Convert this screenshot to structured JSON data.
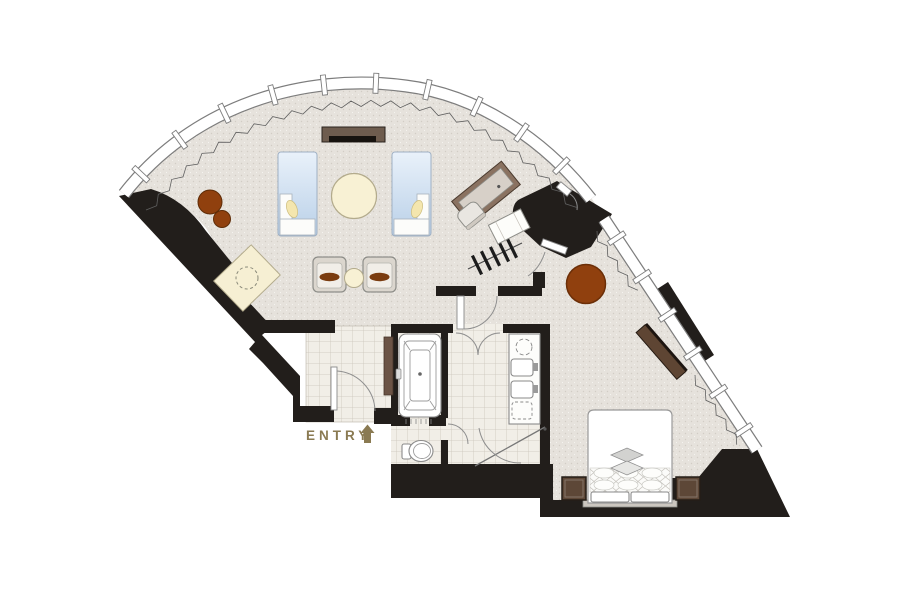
{
  "meta": {
    "title": "Hotel suite floor plan"
  },
  "labels": {
    "entry": "ENTRY"
  },
  "colors": {
    "wall": "#221e1b",
    "carpet": "#e6e2dc",
    "tile": "#f1eee7",
    "tile_grid": "#cbc5ba",
    "window_line": "#7d7d7d",
    "wood_dark": "#6e5c4e",
    "wood_table": "#90400e",
    "cream": "#f8f1d4",
    "sofa_blue": "#c5d8ec",
    "nightstand": "#5d4737",
    "dresser": "#5e4533",
    "wardrobe": "#6b5345",
    "cushion_brown": "#7a3c10",
    "entry_text": "#8a7a52",
    "fixture_line": "#8a8a8a"
  },
  "elements": [
    "curved-window-wall",
    "curtain",
    "side-window-wall",
    "sofa-left",
    "sofa-right",
    "coffee-table",
    "tv-console",
    "armchairs",
    "side-table",
    "minibar-counter",
    "stools",
    "desk",
    "desk-chair",
    "closet-rail",
    "luggage-bench",
    "dining-table",
    "bathtub",
    "toilet",
    "vanity-sinks",
    "shower",
    "entry-door",
    "bathroom-doors",
    "bed",
    "pillows",
    "nightstands",
    "dresser",
    "wardrobe"
  ]
}
